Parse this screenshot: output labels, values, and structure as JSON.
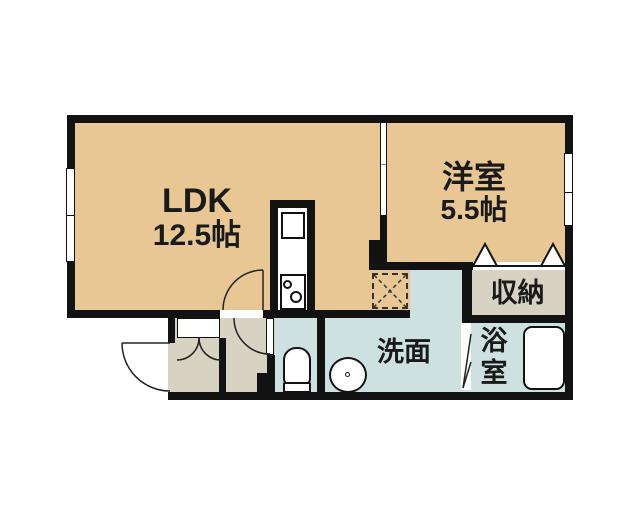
{
  "floorplan": {
    "type": "apartment-floor-plan",
    "rooms": {
      "ldk": {
        "label": "LDK",
        "size": "12.5帖"
      },
      "bedroom": {
        "label": "洋室",
        "size": "5.5帖"
      },
      "storage": {
        "label": "収納"
      },
      "washroom": {
        "label": "洗面"
      },
      "bathroom": {
        "label": "浴室",
        "char1": "浴",
        "char2": "室"
      }
    },
    "fixtures": [
      "kitchen-sink",
      "stove-burners",
      "refrigerator-space",
      "toilet",
      "wash-basin",
      "bathtub",
      "shoe-cabinet"
    ],
    "colors": {
      "room_tan": "#e9c795",
      "room_wet": "#cde1e0",
      "room_gray": "#d8d2c3",
      "wall": "#121212",
      "line": "#222222"
    }
  }
}
